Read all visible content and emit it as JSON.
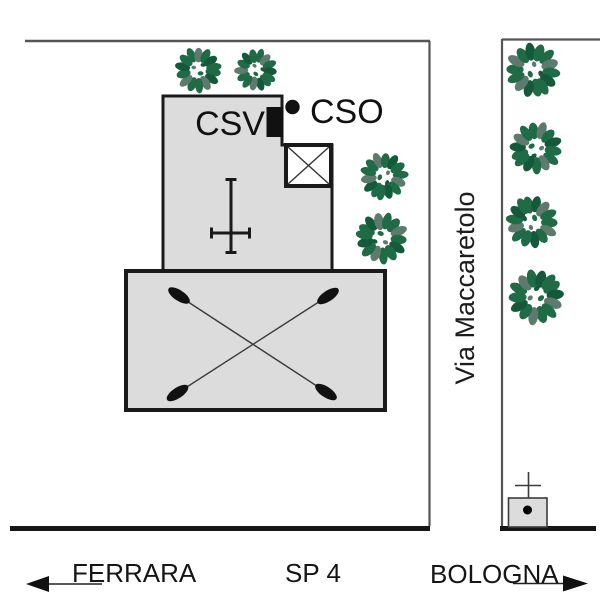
{
  "labels": {
    "csv": "CSV",
    "cso": "CSO",
    "street": "Via Maccaretolo",
    "road": "SP 4",
    "dir_west": "FERRARA",
    "dir_east": "BOLOGNA"
  },
  "icons": {
    "tree": "tree-icon (green leafy wreath shrub)",
    "church_cross": "church-cross-icon",
    "tower": "crossed-square-tower-icon",
    "csv_marker": "black-block-marker",
    "cso_marker": "black-dot-marker",
    "barn_diagonals": "crossed-diagonals-with-oval-ends-icon",
    "chapel_cross": "small-cross-icon",
    "chapel_dot": "black-dot-marker",
    "arrow_west": "arrow-left-icon",
    "arrow_east": "arrow-right-icon"
  },
  "colors": {
    "background": "#ffffff",
    "building_fill": "#dcdcdc",
    "building_outline": "#1a1a1a",
    "boundary_line": "#555555",
    "road_edge": "#161616",
    "tree_green": "#1f6b46",
    "tree_green_dark": "#14593a",
    "tree_gray_green": "#5e7a6c",
    "text": "#111111"
  }
}
